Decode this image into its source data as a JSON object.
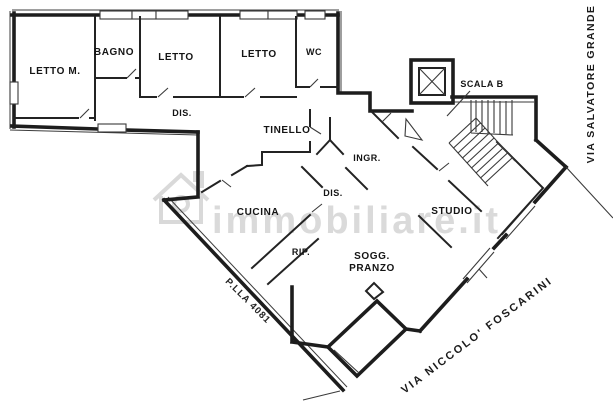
{
  "document": {
    "type": "floor-plan",
    "source_watermark": "immobiliare.it"
  },
  "rooms": {
    "letto_m": "LETTO M.",
    "bagno": "BAGNO",
    "letto1": "LETTO",
    "letto2": "LETTO",
    "wc": "WC",
    "dis1": "DIS.",
    "tinello": "TINELLO",
    "ingresso": "INGR.",
    "dis2": "DIS.",
    "cucina": "CUCINA",
    "rip": "RIP.",
    "soggiorno": {
      "line1": "SOGG.",
      "line2": "PRANZO"
    },
    "studio": "STUDIO",
    "scala": "SCALA B"
  },
  "annotations": {
    "parcel": "P.LLA 4081",
    "street_bottom": "VIA NICCOLO' FOSCARINI",
    "street_right": "VIA SALVATORE GRANDE"
  },
  "watermark": {
    "text": "immobiliare.it"
  },
  "colors": {
    "walls": "#1d1d1d",
    "background": "#ffffff",
    "watermark": "#d9d9d9"
  }
}
